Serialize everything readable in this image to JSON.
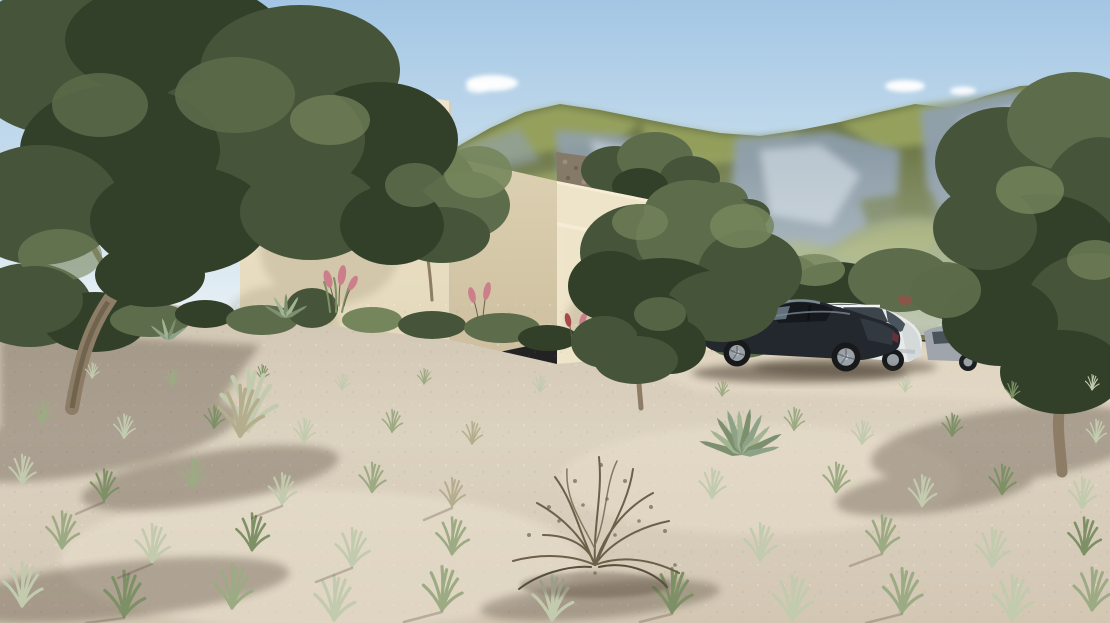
{
  "meta": {
    "type": "3d-architectural-rendering",
    "description": "Exterior rendering of a modern flat-roofed beige villa on a dry grassy hillside with olive trees, parked cars and a rocky green mountain range behind, under a light blue sky"
  },
  "scene": {
    "sky": {
      "label": "blue sky with small white clouds",
      "cloud_count": 4
    },
    "mountains": {
      "label": "rocky mountain range with green slopes and grey limestone cliffs"
    },
    "stone_ruin": {
      "label": "old rubble stone wall behind the villa roof"
    },
    "building": {
      "label": "modern stepped flat-roof villa with beige plaster walls",
      "volumes": [
        "tall two-storey block with parapet cap",
        "middle block with roof trees",
        "low garage wing"
      ],
      "garage_door": {
        "label": "dark grey entrance door"
      },
      "window": {
        "label": "narrow dark vertical window"
      }
    },
    "vehicles": [
      {
        "label": "dark grey sports coupe",
        "color": "#23282e"
      },
      {
        "label": "white estate car",
        "color": "#e8eaea"
      },
      {
        "label": "silver car partly hidden by trees",
        "color": "#9fa5aa"
      }
    ],
    "vegetation": {
      "olive_trees": {
        "label": "gnarled olive trees",
        "count": 5
      },
      "grass": {
        "label": "scattered pale green grass tufts on sandy ground"
      },
      "dry_shrub": {
        "label": "dry twiggy shrub"
      },
      "agave": {
        "label": "spiky agave plants"
      },
      "ornamental": {
        "label": "pink and red plume grasses along the villa base"
      }
    },
    "ground": {
      "label": "sandy beige terrain with long soft shadows"
    },
    "driveway": {
      "label": "light gravel parking area"
    }
  },
  "palette": {
    "sky_top": "#a3c6e4",
    "sky_mid": "#cfe2ef",
    "sky_horizon": "#eaf1f5",
    "cloud": "#ffffff",
    "mountain_rock": "#8fa0b0",
    "mountain_rock_light": "#c6d0d8",
    "mountain_grass": "#9aa55f",
    "mountain_grass_dark": "#6f7a4a",
    "foothill": "#8e9a68",
    "wall_light": "#eee4c9",
    "wall_mid": "#e3d7ba",
    "wall_shaded": "#d6c9ab",
    "wall_cap": "#f2e9d2",
    "stone_ruin": "#857a68",
    "door_dark": "#41464a",
    "window_dark": "#1e2225",
    "ground_light": "#dcd2c0",
    "ground_mid": "#cfc4b0",
    "drive_light": "#e6dcc8",
    "foliage_dark": "#32402a",
    "foliage_mid": "#46553a",
    "foliage_light": "#5d6d4b",
    "foliage_highlight": "#76865c",
    "trunk": "#8d7d66",
    "twig": "#6b6149",
    "grass_pale": "#c2cbae",
    "grass_mid": "#9cab83",
    "grass_green": "#7e9166",
    "grass_dry": "#b5ae8e",
    "pink_plume": "#cb7f8b",
    "red_plume": "#a84848",
    "car_dark_body": "#23282e",
    "car_white_body": "#e8eaea",
    "car_gray_body": "#9fa5aa",
    "rim_silver": "#9aa2a8",
    "shadow": "#3a2f22"
  }
}
